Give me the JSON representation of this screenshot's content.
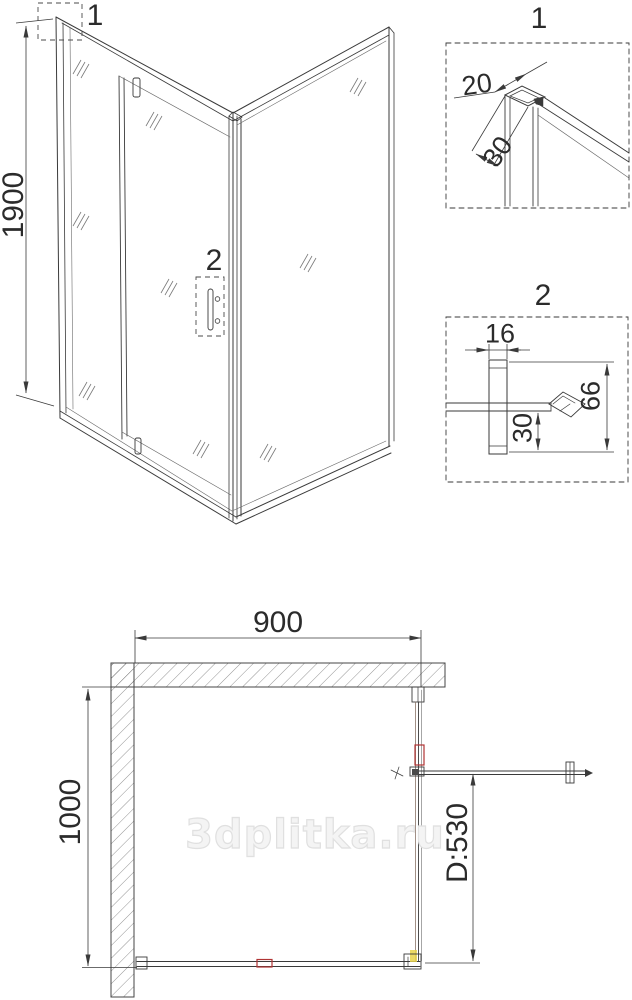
{
  "colors": {
    "line": "#3a3a3a",
    "thin_line": "#6a6a6a",
    "accent_red": "#b03434",
    "accent_yellow": "#e9d34b",
    "watermark_fill": "#f4f4f4",
    "watermark_edge": "#e0e0e0"
  },
  "watermark": {
    "text": "3dplitka.ru"
  },
  "elevation_view": {
    "height_dim_label": "1900",
    "callout_top_corner": "1",
    "callout_door_handle": "2"
  },
  "detail_top_profile": {
    "title": "1",
    "dim_profile_width": "20",
    "dim_profile_depth": "30"
  },
  "detail_handle_section": {
    "title": "2",
    "dim_handle_width": "16",
    "dim_handle_offset": "30",
    "dim_handle_height": "66"
  },
  "plan_view": {
    "dim_width_label": "900",
    "dim_depth_label": "1000",
    "dim_door_label": "D:530"
  }
}
